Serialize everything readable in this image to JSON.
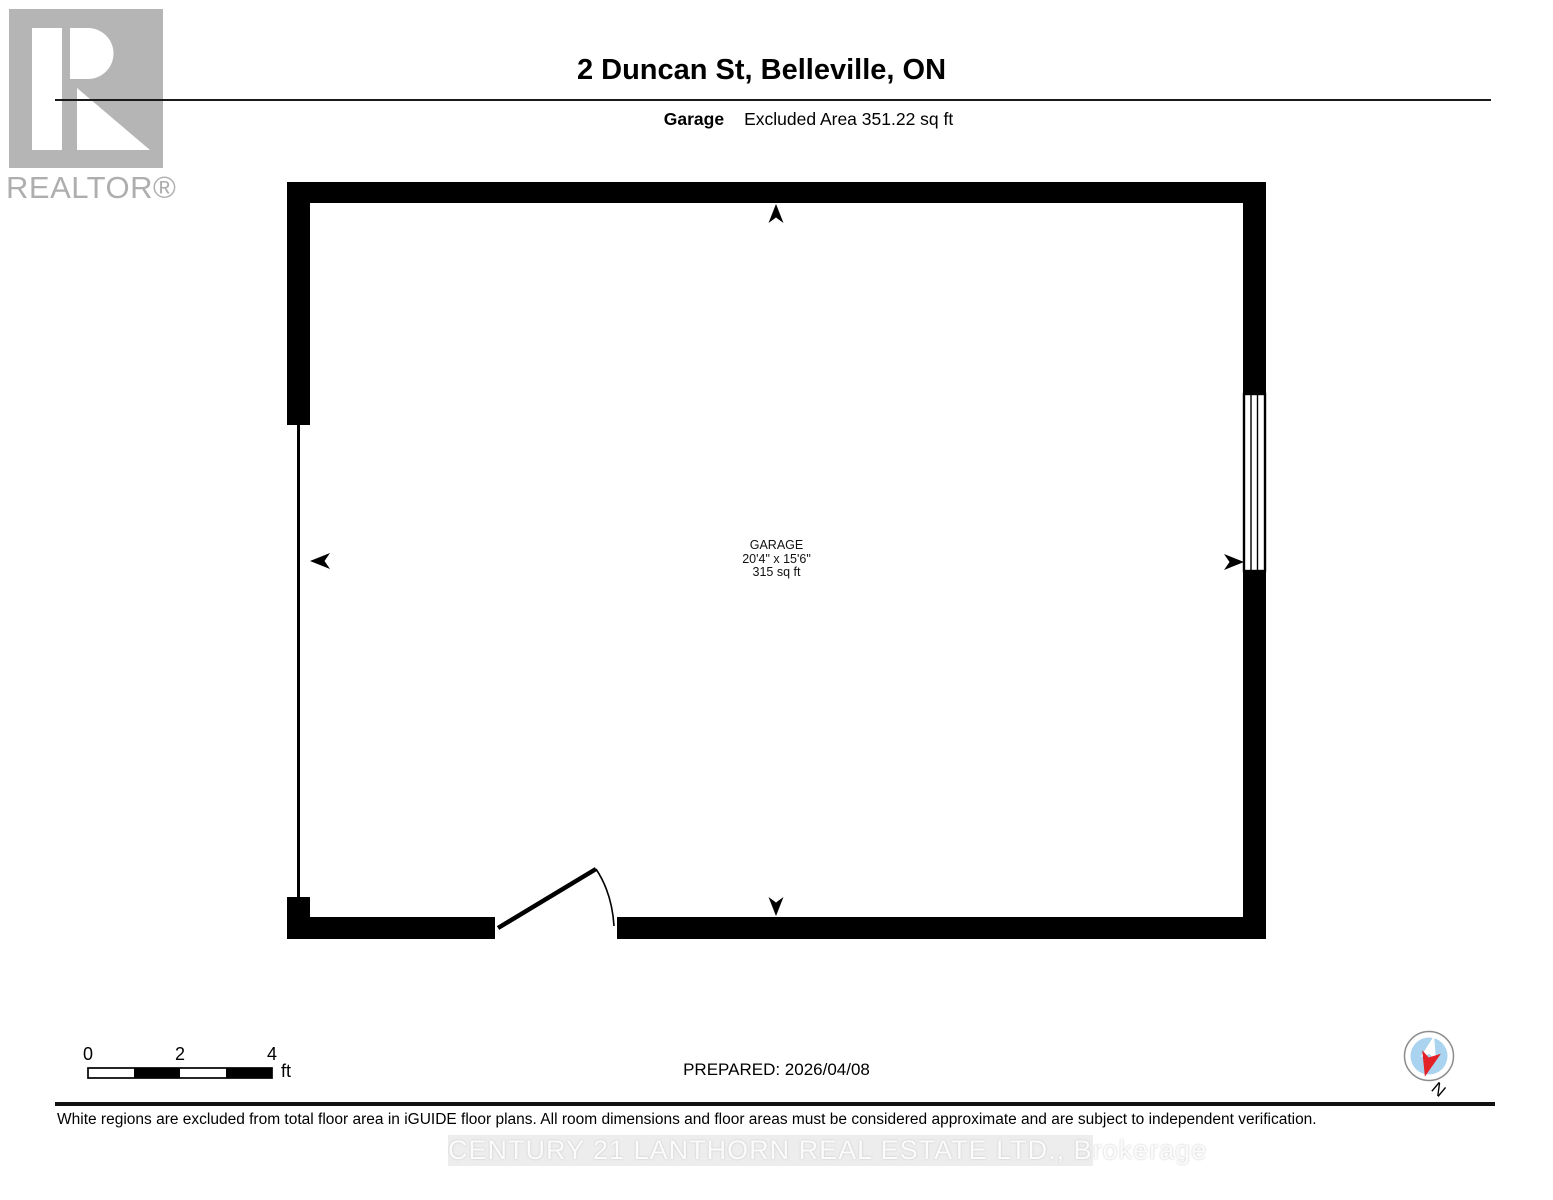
{
  "colors": {
    "wall": "#000000",
    "logo_gray": "#b5b5b5",
    "compass_ring": "#8c8c8c",
    "compass_blue": "#a9d3ef",
    "compass_red": "#e32228",
    "watermark_bg": "#ededed"
  },
  "header": {
    "logo_text": "REALTOR®",
    "title": "2 Duncan St, Belleville, ON",
    "room_name": "Garage",
    "excluded_area": "Excluded Area 351.22 sq ft"
  },
  "plan": {
    "room_label": {
      "name": "GARAGE",
      "dimensions": "20'4\" x 15'6\"",
      "area": "315 sq ft"
    }
  },
  "footer": {
    "scale_bar": {
      "ticks": [
        "0",
        "2",
        "4"
      ],
      "unit": "ft"
    },
    "prepared": "PREPARED: 2026/04/08",
    "compass_label": "N",
    "disclaimer": "White regions are excluded from total floor area in iGUIDE floor plans. All room dimensions and floor areas must be considered approximate and are subject to independent verification.",
    "watermark": "CENTURY 21 LANTHORN REAL ESTATE LTD.,  Brokerage"
  }
}
